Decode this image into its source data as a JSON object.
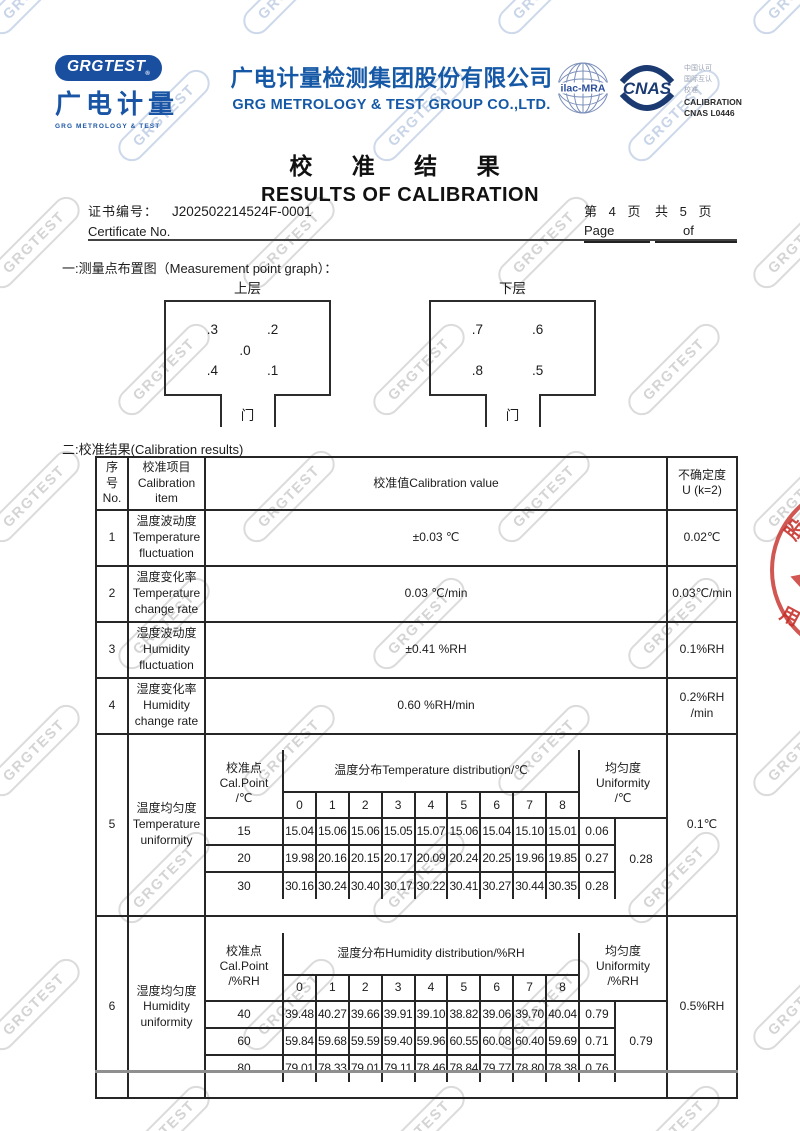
{
  "watermark_text": "GRGTEST",
  "colors": {
    "brand_blue": "#1558a6",
    "cnas_navy": "#1b3a72",
    "seal_red": "#c62d28"
  },
  "header": {
    "logo": {
      "badge": "GRGTEST",
      "reg": "®",
      "cn": "广电计量",
      "en": "GRG METROLOGY & TEST"
    },
    "company_cn": "广电计量检测集团股份有限公司",
    "company_en": "GRG METROLOGY & TEST GROUP CO.,LTD.",
    "accreditation": {
      "ilac": "ilac-MRA",
      "cnas": "CNAS",
      "line1": "中国认可",
      "line2": "国际互认",
      "line3": "校准",
      "calibration": "CALIBRATION",
      "cnas_no": "CNAS L0446"
    }
  },
  "title_cn": "校 准 结 果",
  "title_en": "RESULTS OF CALIBRATION",
  "certificate": {
    "label_cn": "证书编号：",
    "number": "J202502214524F-0001",
    "label_en": "Certificate No.",
    "page_seg1_cn": "第 4 页",
    "page_seg1_en": "Page",
    "page_seg2_cn": "共 5 页",
    "page_seg2_en": "of"
  },
  "section1_heading": "一:测量点布置图（Measurement point graph）：",
  "diagrams": [
    {
      "label": "上层",
      "points": [
        ".3",
        ".2",
        ".0",
        ".4",
        ".1"
      ],
      "door": "门"
    },
    {
      "label": "下层",
      "points": [
        ".7",
        ".6",
        ".8",
        ".5"
      ],
      "door": "门"
    }
  ],
  "section2_heading": "二:校准结果(Calibration results)",
  "table": {
    "headers": {
      "no": "序\n号\nNo.",
      "item": "校准项目\nCalibration\nitem",
      "value": "校准值Calibration value",
      "unc": "不确定度\nU (k=2)"
    },
    "simple_rows": [
      {
        "no": "1",
        "item": "温度波动度\nTemperature\nfluctuation",
        "value": "±0.03 ℃",
        "unc": "0.02℃"
      },
      {
        "no": "2",
        "item": "温度变化率\nTemperature\nchange rate",
        "value": "0.03 ℃/min",
        "unc": "0.03℃/min"
      },
      {
        "no": "3",
        "item": "湿度波动度\nHumidity\nfluctuation",
        "value": "±0.41 %RH",
        "unc": "0.1%RH"
      },
      {
        "no": "4",
        "item": "湿度变化率\nHumidity\nchange rate",
        "value": "0.60 %RH/min",
        "unc": "0.2%RH\n/min"
      }
    ],
    "uniformity_rows": [
      {
        "no": "5",
        "item": "温度均匀度\nTemperature\nuniformity",
        "calpoint_header": "校准点\nCal.Point\n/℃",
        "dist_header": "温度分布Temperature distribution/℃",
        "col_indices": [
          "0",
          "1",
          "2",
          "3",
          "4",
          "5",
          "6",
          "7",
          "8"
        ],
        "unif_header": "均匀度\nUniformity\n/℃",
        "rows": [
          {
            "point": "15",
            "values": [
              "15.04",
              "15.06",
              "15.06",
              "15.05",
              "15.07",
              "15.06",
              "15.04",
              "15.10",
              "15.01"
            ],
            "unif": "0.06"
          },
          {
            "point": "20",
            "values": [
              "19.98",
              "20.16",
              "20.15",
              "20.17",
              "20.09",
              "20.24",
              "20.25",
              "19.96",
              "19.85"
            ],
            "unif": "0.27"
          },
          {
            "point": "30",
            "values": [
              "30.16",
              "30.24",
              "30.40",
              "30.17",
              "30.22",
              "30.41",
              "30.27",
              "30.44",
              "30.35"
            ],
            "unif": "0.28"
          }
        ],
        "combined": "0.28",
        "unc": "0.1℃"
      },
      {
        "no": "6",
        "item": "湿度均匀度\nHumidity\nuniformity",
        "calpoint_header": "校准点\nCal.Point\n/%RH",
        "dist_header": "湿度分布Humidity distribution/%RH",
        "col_indices": [
          "0",
          "1",
          "2",
          "3",
          "4",
          "5",
          "6",
          "7",
          "8"
        ],
        "unif_header": "均匀度\nUniformity\n/%RH",
        "rows": [
          {
            "point": "40",
            "values": [
              "39.48",
              "40.27",
              "39.66",
              "39.91",
              "39.10",
              "38.82",
              "39.06",
              "39.70",
              "40.04"
            ],
            "unif": "0.79"
          },
          {
            "point": "60",
            "values": [
              "59.84",
              "59.68",
              "59.59",
              "59.40",
              "59.96",
              "60.55",
              "60.08",
              "60.40",
              "59.69"
            ],
            "unif": "0.71"
          },
          {
            "point": "80",
            "values": [
              "79.01",
              "78.33",
              "79.01",
              "79.11",
              "78.46",
              "78.84",
              "79.77",
              "78.80",
              "78.38"
            ],
            "unif": "0.76"
          }
        ],
        "combined": "0.79",
        "unc": "0.5%RH"
      }
    ]
  },
  "seal": {
    "char1": "股",
    "char2": "份",
    "char3": "用",
    "char4": "章"
  }
}
